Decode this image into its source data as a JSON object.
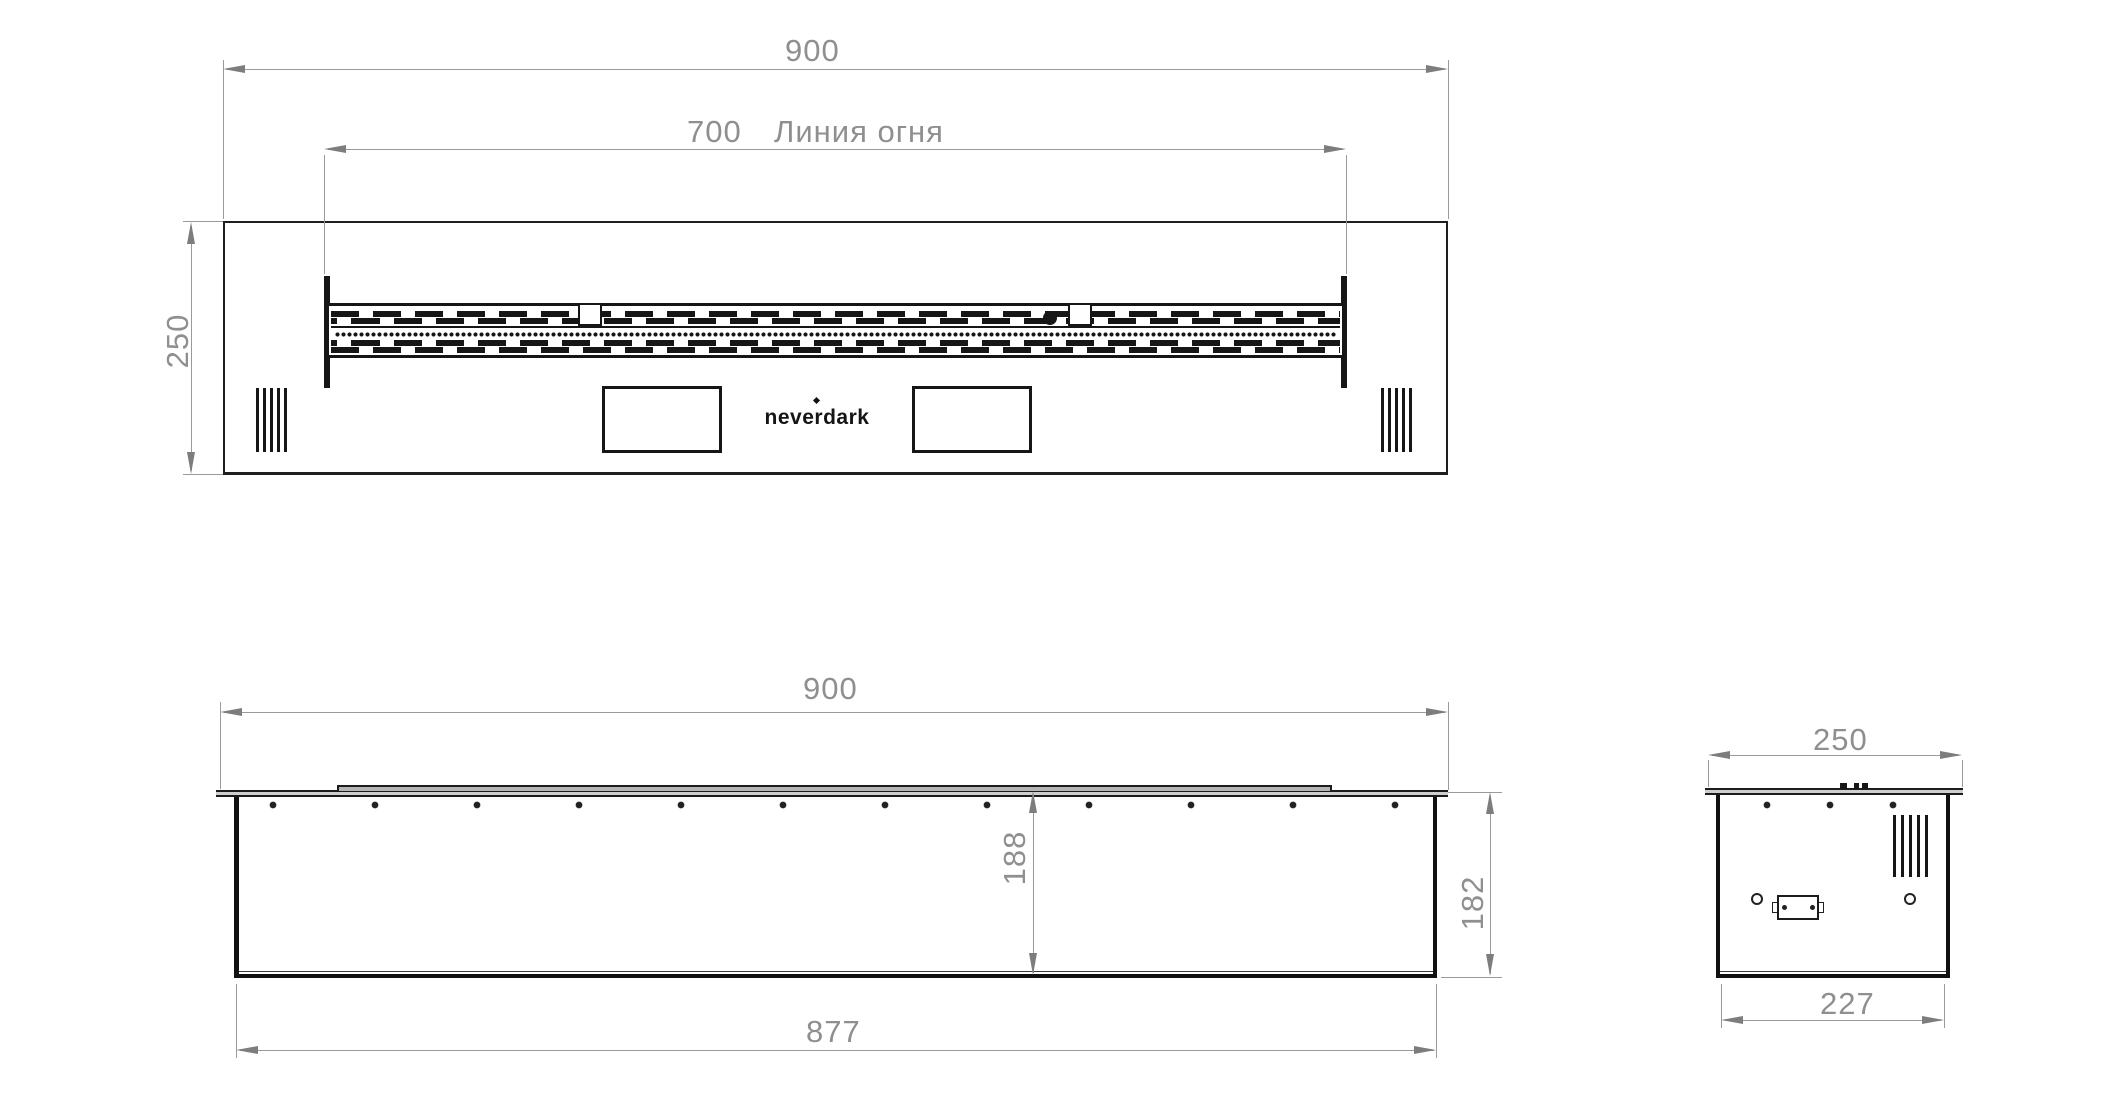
{
  "brand": {
    "logo": "neverdark"
  },
  "top_view": {
    "width": "900",
    "fire_line_value": "700",
    "fire_line_label": "Линия огня",
    "depth": "250"
  },
  "front_view": {
    "width": "900",
    "inner_depth": "188",
    "body_height": "182",
    "body_width": "877"
  },
  "side_view": {
    "width": "250",
    "bottom_width": "227"
  },
  "colors": {
    "drawing_line": "#1c1c1c",
    "dimension_line": "#9a9a9a",
    "dimension_text": "#8f8f8f",
    "background": "#ffffff"
  }
}
